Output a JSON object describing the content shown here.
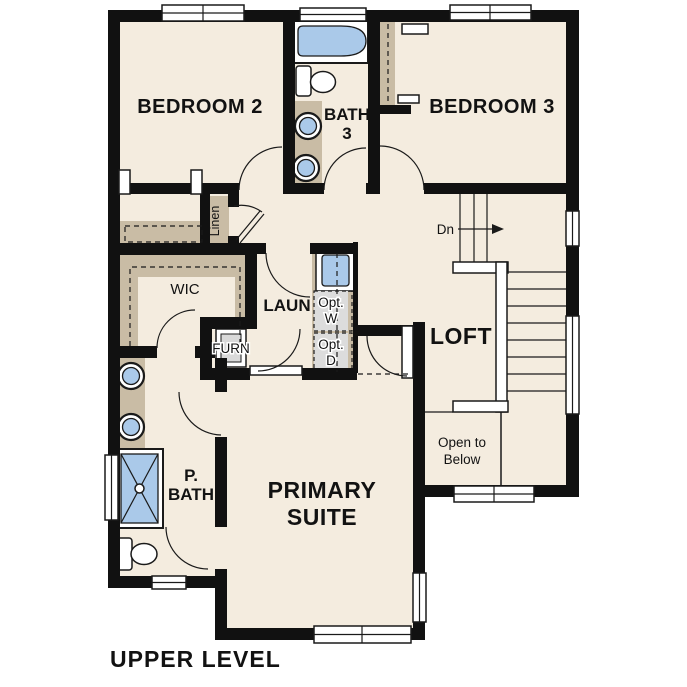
{
  "page": {
    "title": "UPPER LEVEL"
  },
  "colors": {
    "background": "#ffffff",
    "floor": "#f4ecdf",
    "wall": "#111111",
    "casework_tan": "#c9bca5",
    "fixture_blue": "#aac9e9",
    "appliance_gray": "#dcdcdc",
    "line": "#1a1a1a"
  },
  "rooms": {
    "bedroom2": {
      "label": "BEDROOM 2"
    },
    "bath3": {
      "line1": "BATH",
      "line2": "3"
    },
    "bedroom3": {
      "label": "BEDROOM 3"
    },
    "linen": {
      "label": "Linen"
    },
    "wic": {
      "label": "WIC"
    },
    "laundry": {
      "label": "LAUN"
    },
    "furnace": {
      "label": "FURN"
    },
    "loft": {
      "label": "LOFT"
    },
    "primary_suite": {
      "line1": "PRIMARY",
      "line2": "SUITE"
    },
    "primary_bath": {
      "line1": "P.",
      "line2": "BATH"
    },
    "open_to_below": {
      "line1": "Open to",
      "line2": "Below"
    }
  },
  "annotations": {
    "stair_direction": "Dn",
    "opt_washer": {
      "line1": "Opt.",
      "line2": "W"
    },
    "opt_dryer": {
      "line1": "Opt.",
      "line2": "D"
    }
  }
}
